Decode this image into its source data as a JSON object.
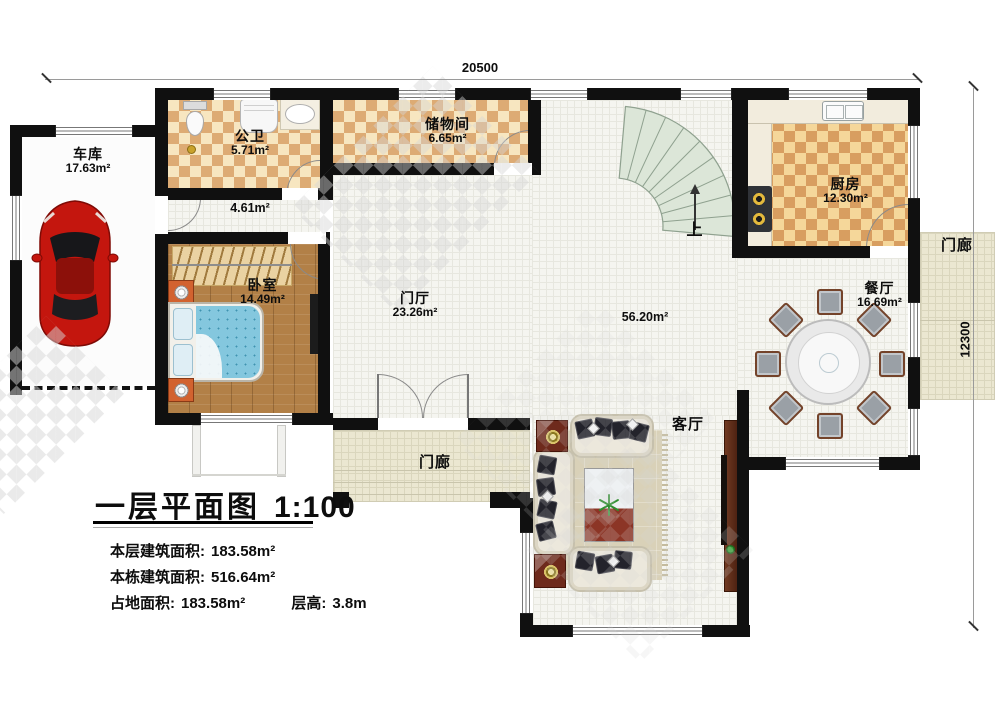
{
  "plan": {
    "dimensions": {
      "top": "20500",
      "right": "12300"
    },
    "rooms": {
      "garage": {
        "label": "车库",
        "area": "17.63m²"
      },
      "bathroom": {
        "label": "公卫",
        "area": "5.71m²"
      },
      "storage": {
        "label": "储物间",
        "area": "6.65m²"
      },
      "kitchen": {
        "label": "厨房",
        "area": "12.30m²"
      },
      "corridor": {
        "area": "4.61m²"
      },
      "bedroom": {
        "label": "卧室",
        "area": "14.49m²"
      },
      "foyer": {
        "label": "门厅",
        "area": "23.26m²"
      },
      "hall": {
        "area": "56.20m²"
      },
      "dining": {
        "label": "餐厅",
        "area": "16.69m²"
      },
      "living": {
        "label": "客厅"
      },
      "porch_bottom": {
        "label": "门廊"
      },
      "porch_right": {
        "label": "门廊"
      }
    },
    "stairs_up": "上",
    "title": {
      "text": "一层平面图",
      "scale": "1:100"
    },
    "stats": [
      {
        "label": "本层建筑面积:",
        "value": "183.58m²"
      },
      {
        "label": "本栋建筑面积:",
        "value": "516.64m²"
      },
      {
        "label": "占地面积:",
        "value": "183.58m²"
      },
      {
        "label": "层高:",
        "value": "3.8m"
      }
    ]
  }
}
